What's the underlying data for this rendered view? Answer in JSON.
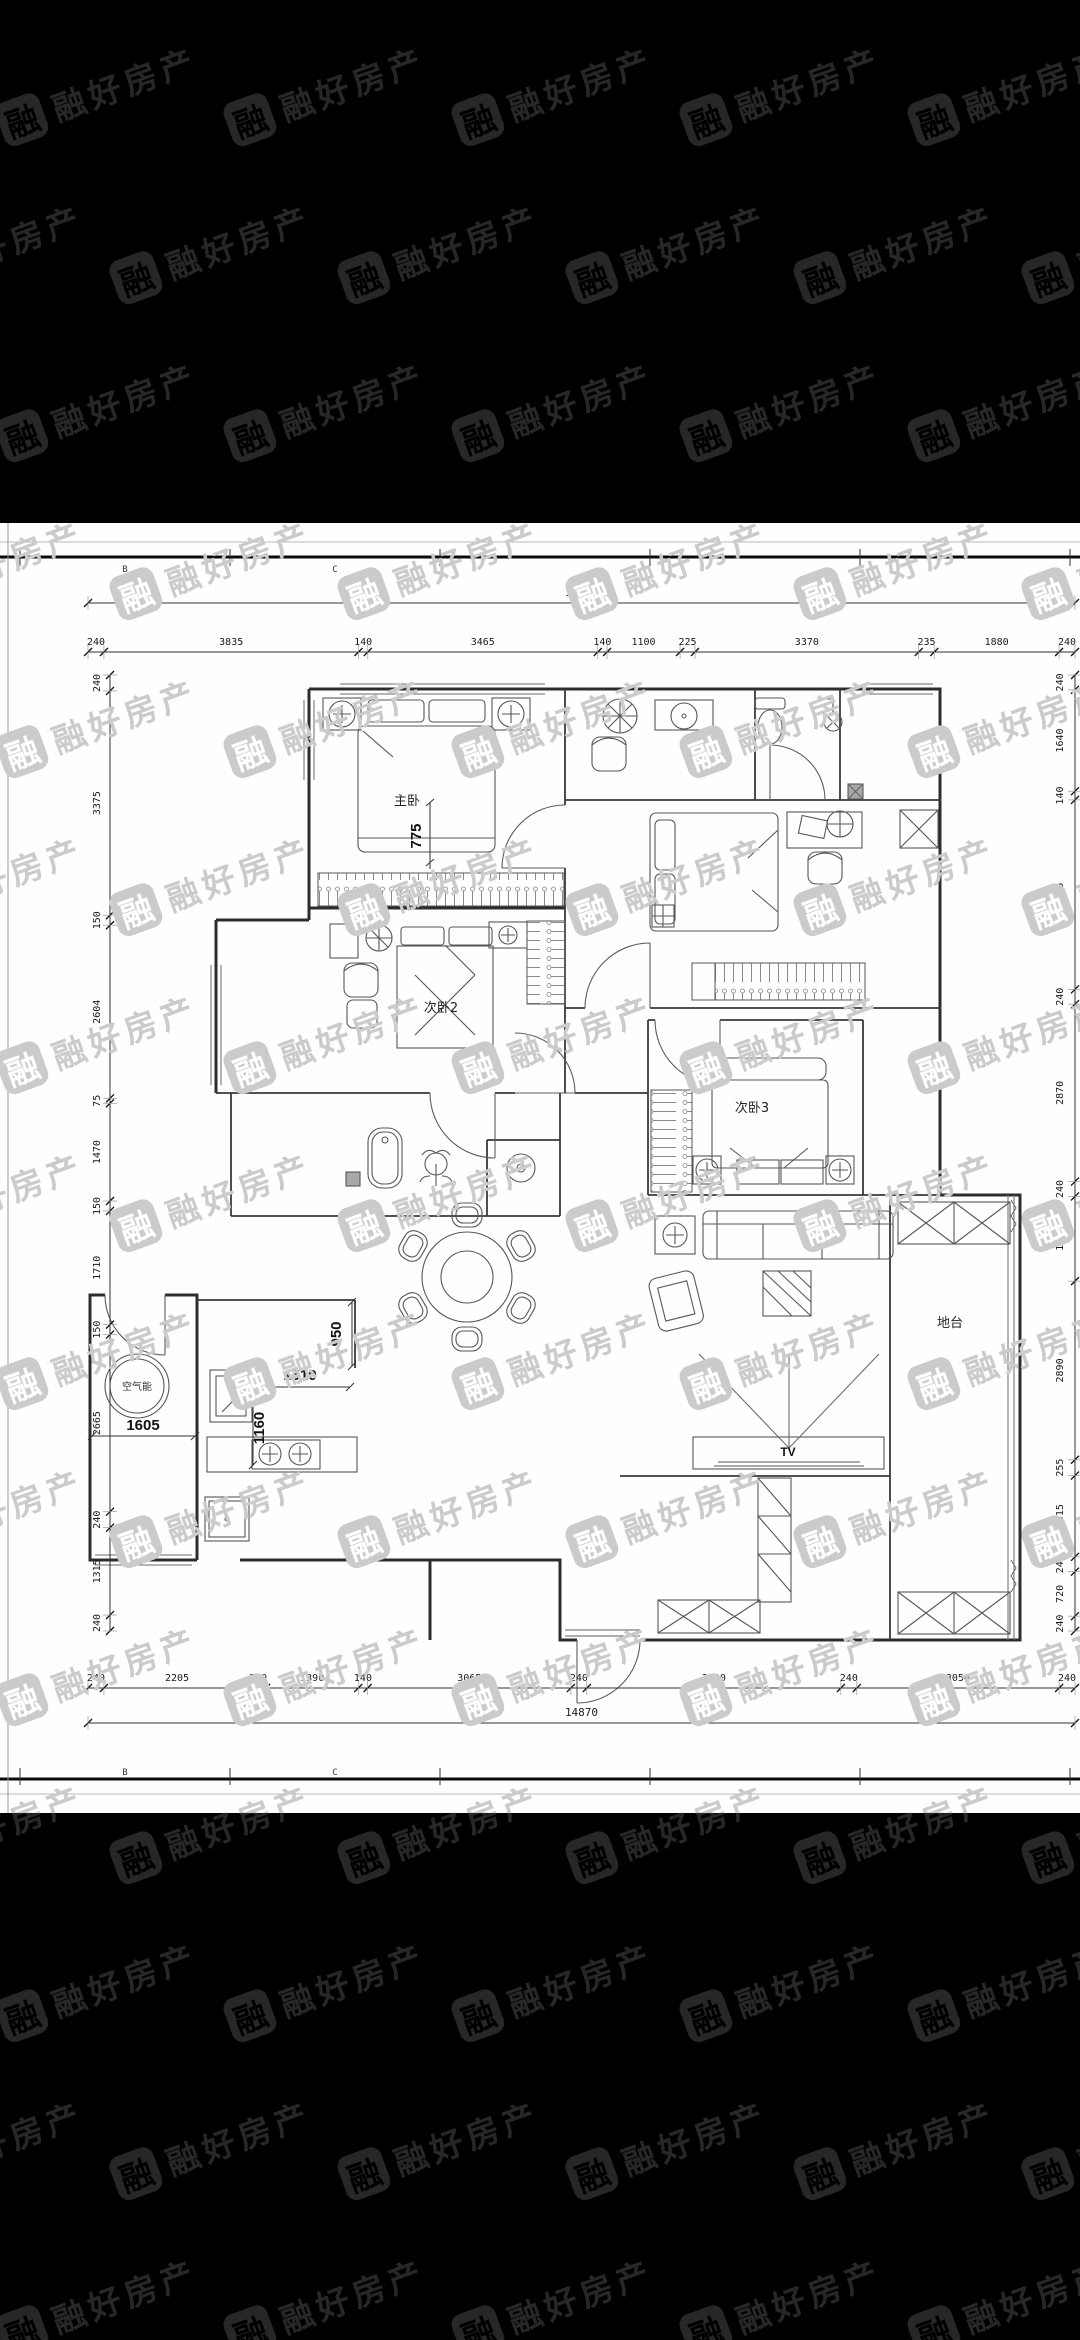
{
  "watermark": {
    "logo_char": "融",
    "text": "融好房产"
  },
  "sheet": {
    "grid_letters": [
      "B",
      "C"
    ]
  },
  "rooms": {
    "master": "主卧",
    "bedroom2": "次卧2",
    "bedroom3": "次卧3",
    "platform": "地台"
  },
  "annotations": {
    "tv": "TV",
    "heat_pump": "空气能",
    "master_dim": "775",
    "kitchen_dim_950": "950",
    "kitchen_dim_1510": "1510",
    "kitchen_dim_1160": "1160",
    "balcony_dim_1605": "1605"
  },
  "dimensions": {
    "top": {
      "total": "14870",
      "segments": [
        "240",
        "3835",
        "140",
        "3465",
        "140",
        "1100",
        "225",
        "3370",
        "235",
        "1880",
        "240"
      ]
    },
    "bottom": {
      "total": "14870",
      "segments": [
        "240",
        "2205",
        "240",
        "1390",
        "140",
        "3065",
        "240",
        "3830",
        "240",
        "3050",
        "240"
      ]
    },
    "left": {
      "segments": [
        "240",
        "3375",
        "150",
        "2604",
        "75",
        "1470",
        "150",
        "1710",
        "150",
        "2665",
        "240",
        "1315",
        "240"
      ]
    },
    "right": {
      "segments": [
        "240",
        "1640",
        "140",
        "3065",
        "240",
        "2870",
        "240",
        "1370",
        "2890",
        "255",
        "1315",
        "240",
        "720",
        "240"
      ]
    }
  }
}
